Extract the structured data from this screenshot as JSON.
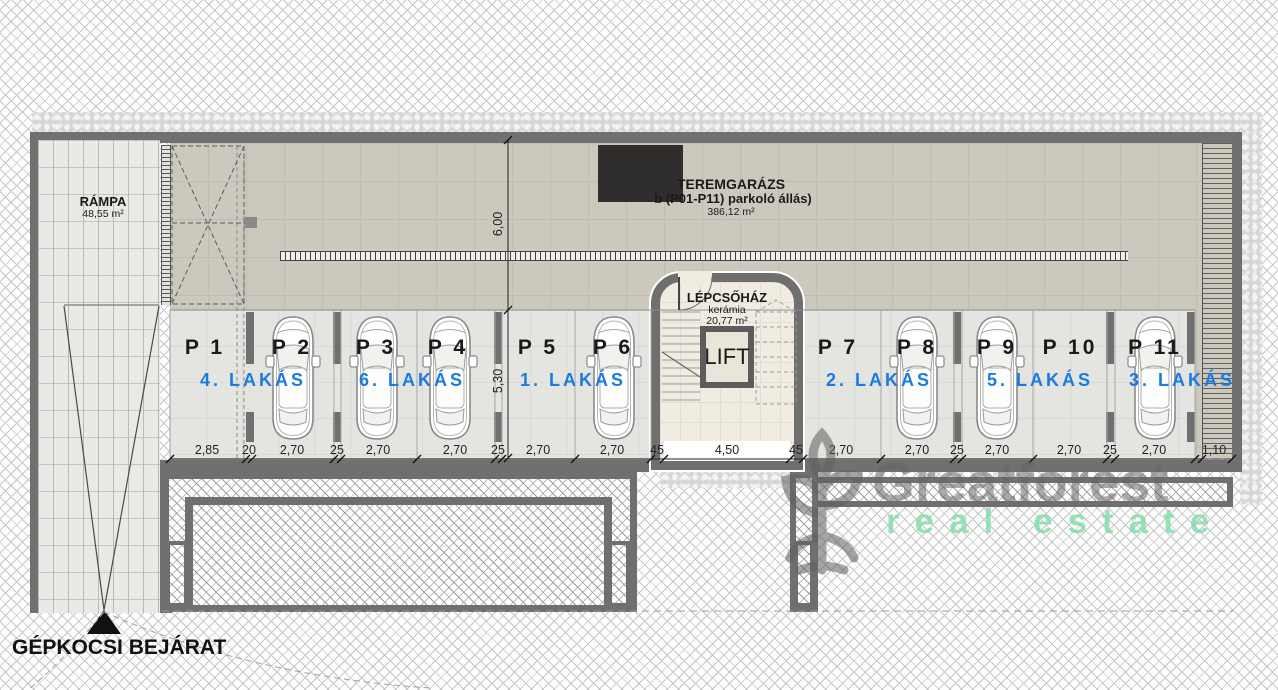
{
  "plan": {
    "garage": {
      "title": "TEREMGARÁZS",
      "subtitle": "b (P01-P11) parkoló állás)",
      "area": "386,12 m²"
    },
    "ramp": {
      "label": "RÁMPA",
      "area": "48,55 m²"
    },
    "staircase": {
      "label": "LÉPCSŐHÁZ",
      "material": "kerámia",
      "area": "20,77 m²",
      "lift_label": "LIFT"
    },
    "entrance_label": "GÉPKOCSI BEJÁRAT",
    "stalls": [
      {
        "id": "P 1"
      },
      {
        "id": "P 2"
      },
      {
        "id": "P 3"
      },
      {
        "id": "P 4"
      },
      {
        "id": "P 5"
      },
      {
        "id": "P 6"
      },
      {
        "id": "P 7"
      },
      {
        "id": "P 8"
      },
      {
        "id": "P 9"
      },
      {
        "id": "P 10"
      },
      {
        "id": "P 11"
      }
    ],
    "apartments": [
      {
        "label": "4. LAKÁS"
      },
      {
        "label": "6. LAKÁS"
      },
      {
        "label": "1. LAKÁS"
      },
      {
        "label": "2. LAKÁS"
      },
      {
        "label": "5. LAKÁS"
      },
      {
        "label": "3. LAKÁS"
      }
    ],
    "dims_bottom": [
      {
        "v": "2,85"
      },
      {
        "v": "20"
      },
      {
        "v": "2,70"
      },
      {
        "v": "25"
      },
      {
        "v": "2,70"
      },
      {
        "v": "2,70"
      },
      {
        "v": "25"
      },
      {
        "v": "2,70"
      },
      {
        "v": "2,70"
      },
      {
        "v": "45"
      },
      {
        "v": "4,50"
      },
      {
        "v": "45"
      },
      {
        "v": "2,70"
      },
      {
        "v": "2,70"
      },
      {
        "v": "25"
      },
      {
        "v": "2,70"
      },
      {
        "v": "2,70"
      },
      {
        "v": "25"
      },
      {
        "v": "2,70"
      },
      {
        "v": "1,10"
      }
    ],
    "dims_vertical": [
      {
        "v": "6,00"
      },
      {
        "v": "5,30"
      }
    ]
  },
  "watermark": {
    "brand": "Greatforest",
    "tagline": "real estate"
  },
  "colors": {
    "apartment_blue": "#1a7ce2",
    "wall_gray": "#707070",
    "watermark_green": "#7ddca5",
    "blackout": "#2f2e2d"
  }
}
